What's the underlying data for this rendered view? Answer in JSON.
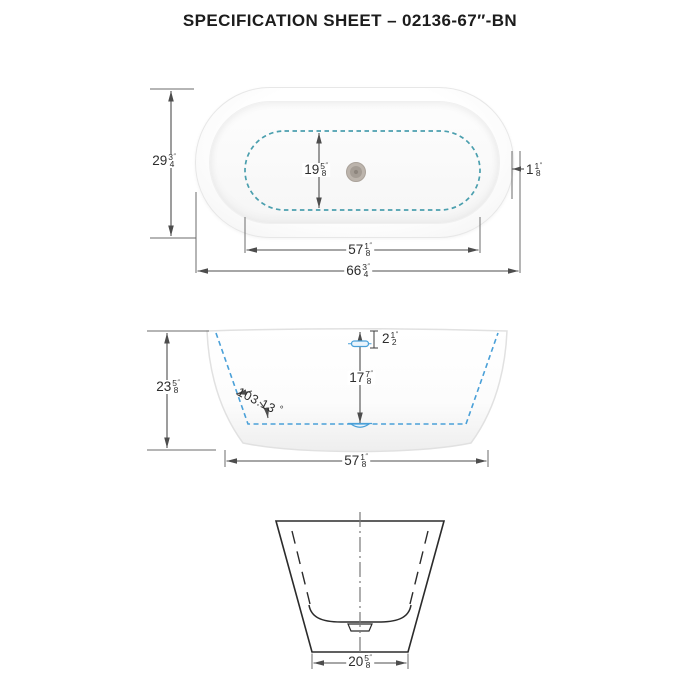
{
  "sheet": {
    "title": "SPECIFICATION SHEET – 02136-67″-BN"
  },
  "colors": {
    "top_view_dashed": "#4b9fae",
    "front_view_dashed": "#4aa0d8",
    "dimension_line": "#4d4d4d",
    "text": "#2d2d2d"
  },
  "views": {
    "top": {
      "dims": {
        "overall_width": {
          "whole": "29",
          "num": "3",
          "den": "4",
          "unit": "″"
        },
        "basin_width": {
          "whole": "19",
          "num": "5",
          "den": "8",
          "unit": "″"
        },
        "rim_width": {
          "whole": "1",
          "num": "1",
          "den": "8",
          "unit": "″"
        },
        "basin_length": {
          "whole": "57",
          "num": "1",
          "den": "8",
          "unit": "″"
        },
        "overall_length": {
          "whole": "66",
          "num": "3",
          "den": "4",
          "unit": "″"
        }
      }
    },
    "front": {
      "dims": {
        "overall_height": {
          "whole": "23",
          "num": "5",
          "den": "8",
          "unit": "″"
        },
        "overflow_drop": {
          "whole": "2",
          "num": "1",
          "den": "2",
          "unit": "″"
        },
        "water_depth": {
          "whole": "17",
          "num": "7",
          "den": "8",
          "unit": "″"
        },
        "wall_angle": {
          "value": "103.13",
          "unit": "°"
        },
        "base_length": {
          "whole": "57",
          "num": "1",
          "den": "8",
          "unit": "″"
        }
      }
    },
    "side": {
      "dims": {
        "base_width": {
          "whole": "20",
          "num": "5",
          "den": "8",
          "unit": "″"
        }
      }
    }
  }
}
